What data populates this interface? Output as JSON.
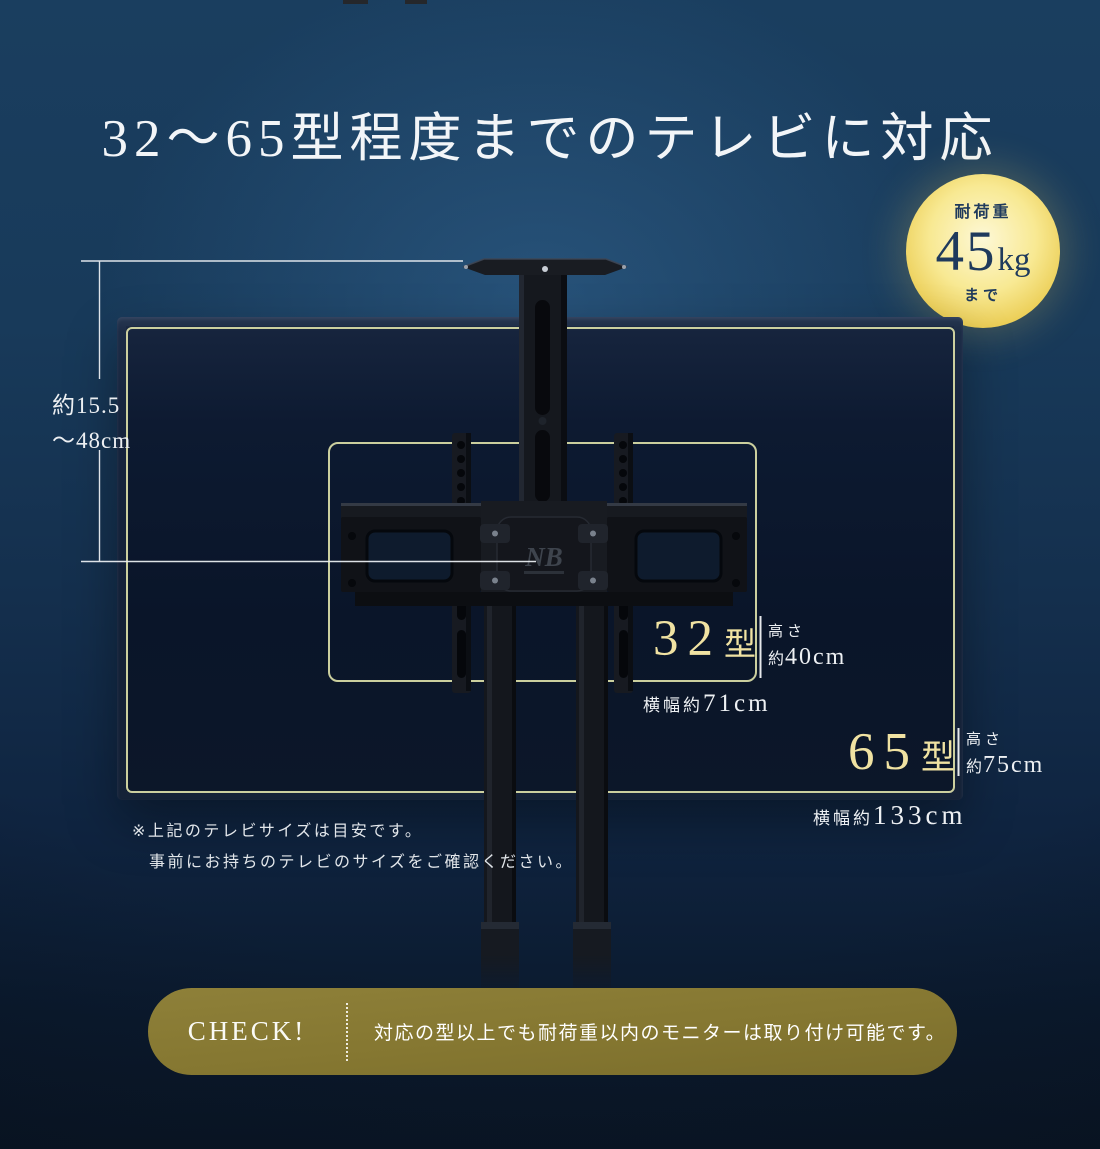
{
  "title": "32〜65型程度までのテレビに対応",
  "badge": {
    "label_top": "耐荷重",
    "value": "45",
    "unit": "kg",
    "label_bottom": "まで"
  },
  "arm_range": {
    "line1": "約15.5",
    "line2": "〜48cm"
  },
  "size32": {
    "number": "32",
    "suffix": "型",
    "height_label": "高さ",
    "height_prefix": "約",
    "height_value": "40cm",
    "width_label": "横幅約",
    "width_value": "71cm"
  },
  "size65": {
    "number": "65",
    "suffix": "型",
    "height_label": "高さ",
    "height_prefix": "約",
    "height_value": "75cm",
    "width_label": "横幅約",
    "width_value": "133cm"
  },
  "note": {
    "line1": "※上記のテレビサイズは目安です。",
    "line2": "事前にお持ちのテレビのサイズをご確認ください。"
  },
  "check": {
    "label": "CHECK!",
    "text": "対応の型以上でも耐荷重以内のモニターは取り付け可能です。"
  },
  "mount": {
    "logo": "NB"
  },
  "colors": {
    "background_top": "#1C4163",
    "background_bottom": "#0A1626",
    "badge_gold": "#EDD35B",
    "badge_text": "#1F3A5C",
    "outline_khaki": "#D6D9A4",
    "accent_gold_text": "#F0E2A2",
    "check_bar_olive": "#857731",
    "label_white": "#EDF0F3"
  }
}
